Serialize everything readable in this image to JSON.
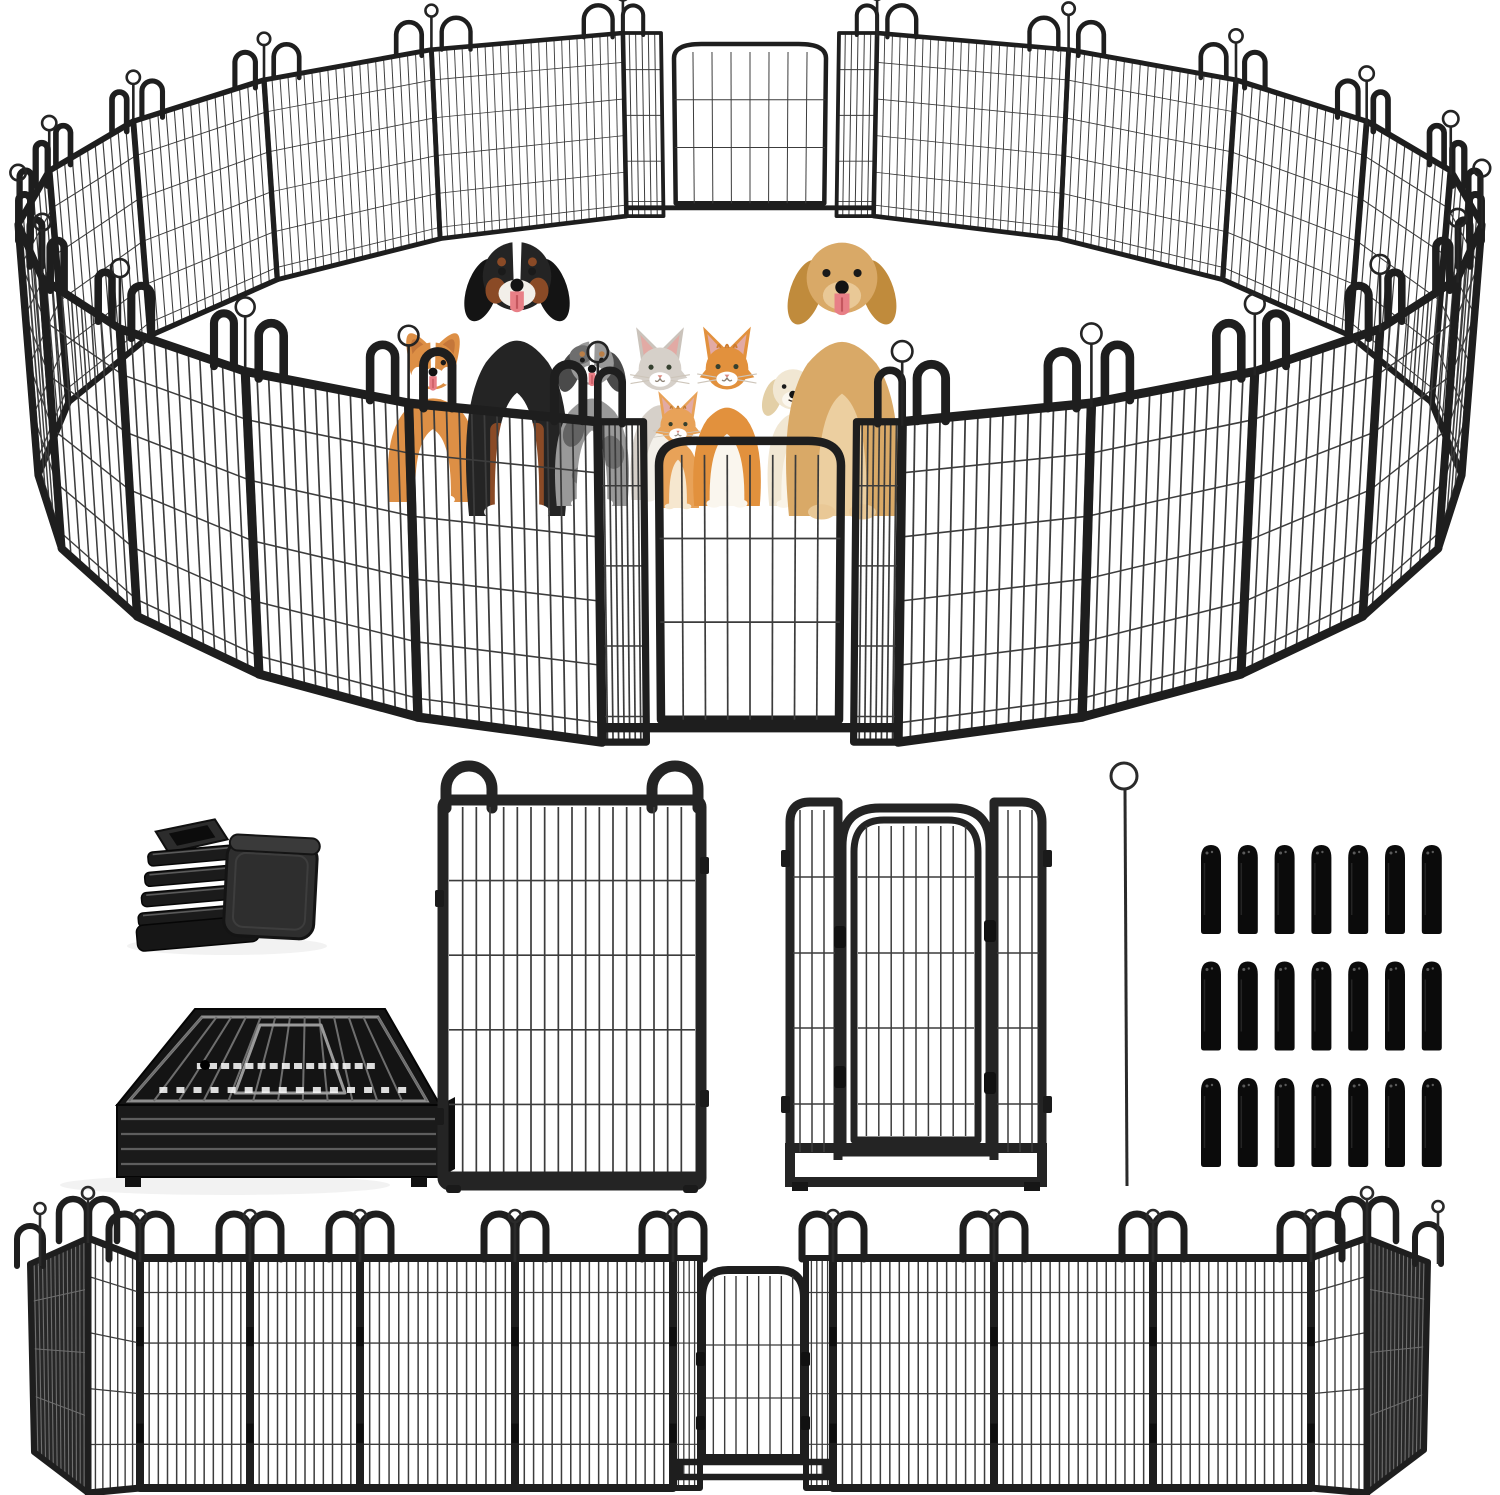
{
  "scene": {
    "title": "Heavy-duty metal dog playpen product photo: circular pen with pets, parts close-ups, and straight fence run",
    "width": 1500,
    "height": 1495,
    "background": "#ffffff"
  },
  "colors": {
    "frame": "#1e1e1e",
    "frame_dark": "#111111",
    "wire": "#3c3c3c",
    "wire_light": "#6f6f6f",
    "metal_highlight": "#929292",
    "edge_panel_fill": "#272727",
    "rubber": "#0b0b0b",
    "shadow": "#000000"
  },
  "ring": {
    "panel_count": 20,
    "door_count": 2,
    "cx": 750,
    "top_ellipse": {
      "cy": 228,
      "rx": 732,
      "ry": 198
    },
    "bottom_ellipse": {
      "cy": 480,
      "rx": 712,
      "ry": 268
    },
    "front_door_deg": [
      78,
      102
    ],
    "back_door_deg": [
      260,
      280
    ],
    "horizontal_wire_fracs": [
      0.16,
      0.36,
      0.56,
      0.76,
      0.94
    ]
  },
  "animals": [
    {
      "id": "corgi",
      "species": "corgi-dog",
      "x": 433,
      "base_y": 502,
      "height": 162,
      "body": "#dd8f45",
      "accent": "#ffffff"
    },
    {
      "id": "bernese",
      "species": "bernese-mountain-dog",
      "x": 517,
      "base_y": 516,
      "height": 274,
      "body": "#242424",
      "accent": "#8a4a26"
    },
    {
      "id": "aussie",
      "species": "australian-shepherd-puppy",
      "x": 592,
      "base_y": 506,
      "height": 168,
      "body": "#999999",
      "accent": "#6e6e6e"
    },
    {
      "id": "gray-cat",
      "species": "gray-cat",
      "x": 660,
      "base_y": 500,
      "height": 158,
      "body": "#d6d0c9",
      "accent": "#f3f0ea"
    },
    {
      "id": "orange-kitten",
      "species": "orange-kitten",
      "x": 678,
      "base_y": 508,
      "height": 110,
      "body": "#e8a258",
      "accent": "#c07a2e"
    },
    {
      "id": "orange-cat",
      "species": "orange-white-cat",
      "x": 727,
      "base_y": 506,
      "height": 164,
      "body": "#e2913d",
      "accent": "#faf6ee"
    },
    {
      "id": "cream-puppy",
      "species": "cream-puppy",
      "x": 793,
      "base_y": 506,
      "height": 144,
      "body": "#f1e7d3",
      "accent": "#e3cfa6"
    },
    {
      "id": "golden",
      "species": "golden-retriever",
      "x": 842,
      "base_y": 516,
      "height": 272,
      "body": "#d9a967",
      "accent": "#eccfa0"
    }
  ],
  "parts": {
    "corner_caps": {
      "count": 2,
      "x": 132,
      "y": 818
    },
    "folded_stack": {
      "x": 55,
      "y": 1005,
      "slats": 4
    },
    "sample_panel": {
      "x": 443,
      "y": 768,
      "w": 258,
      "h": 420,
      "vertical_wires": 18,
      "horizontal_wire_fracs": [
        0.2,
        0.4,
        0.6,
        0.8
      ]
    },
    "sample_door": {
      "x": 786,
      "y": 800,
      "w": 258,
      "h": 390
    },
    "ground_stake": {
      "x": 1127,
      "y_top": 763,
      "y_bottom": 1186,
      "ring_r": 13
    },
    "rubber_tips": {
      "rows": 3,
      "cols": 7,
      "total": 21,
      "x": 1201,
      "y": 845,
      "pitch_x": 36.8,
      "pitch_y": 116.5,
      "tip_w": 20,
      "tip_h": 86
    }
  },
  "bottom_row": {
    "y_top": 1258,
    "y_bottom": 1488,
    "junctions": [
      140,
      250,
      360,
      515,
      673,
      833,
      994,
      1153,
      1311
    ],
    "door": {
      "x1": 673,
      "x2": 833
    },
    "horizontal_wire_fracs": [
      0.15,
      0.37,
      0.59,
      0.81
    ]
  }
}
